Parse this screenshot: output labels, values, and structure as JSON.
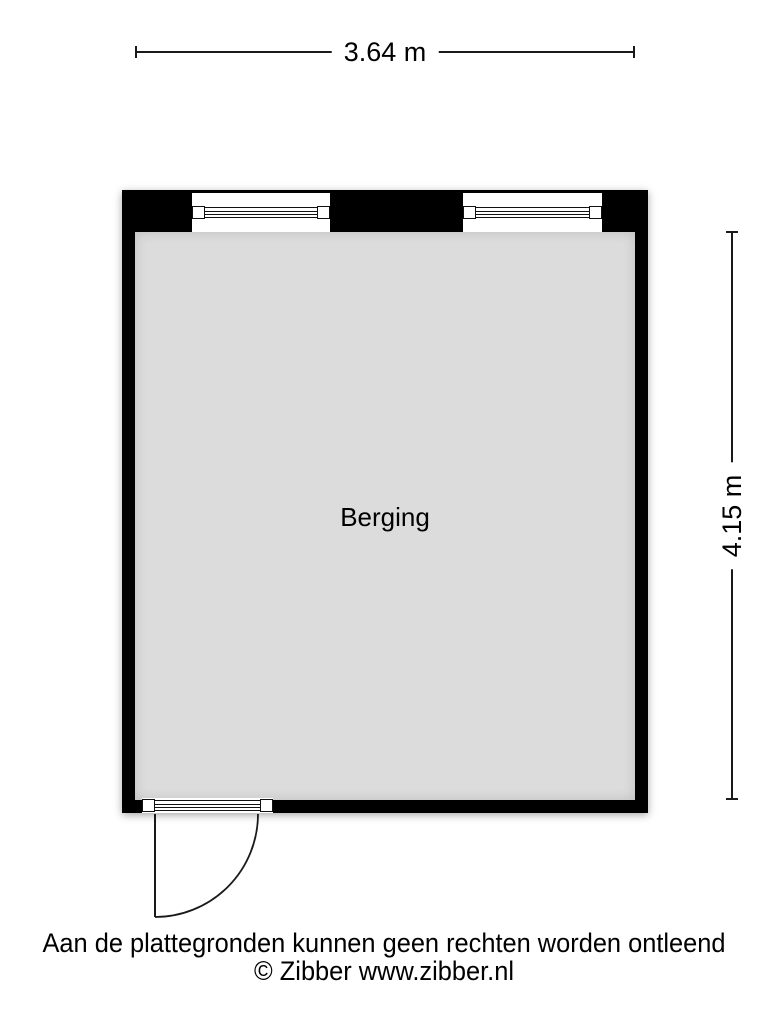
{
  "floorplan": {
    "room": {
      "label": "Berging"
    },
    "dimensions": {
      "width": "3.64 m",
      "height": "4.15 m"
    },
    "colors": {
      "wall": "#000000",
      "floor": "#dcdcdc",
      "dimension_line": "#1a1a1a",
      "background": "#ffffff"
    }
  },
  "footer": {
    "disclaimer": "Aan de plattegronden kunnen geen rechten worden ontleend",
    "copyright": "© Zibber www.zibber.nl"
  }
}
